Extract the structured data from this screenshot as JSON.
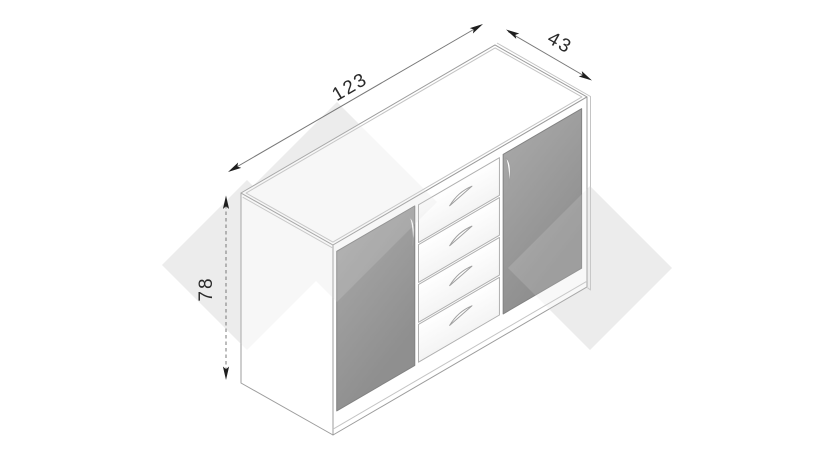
{
  "drawing": {
    "subject": "sideboard-isometric-technical-drawing",
    "dimensions": {
      "width": "123",
      "depth": "43",
      "height": "78"
    },
    "features": {
      "door_count": 2,
      "drawer_count": 4
    }
  },
  "icons": {
    "dimension_arrow": "dimension-arrowhead",
    "door_handle": "curved-vertical-door-handle",
    "drawer_handle": "curved-drawer-handle"
  },
  "colors": {
    "background": "#ffffff",
    "watermark": "#f1f1f1",
    "watermark-overlay": "#dcdcdc",
    "door-light": "#a6a6a6",
    "door-dark": "#8f8f8f",
    "door-edge": "#828282",
    "edge": "#9c9c9c",
    "inset": "#c4c4c4",
    "drawer-edge": "#b0b0b0",
    "dim-line": "#787878",
    "dim-text": "#2a2a2a",
    "arrow": "#1f1f1f"
  }
}
